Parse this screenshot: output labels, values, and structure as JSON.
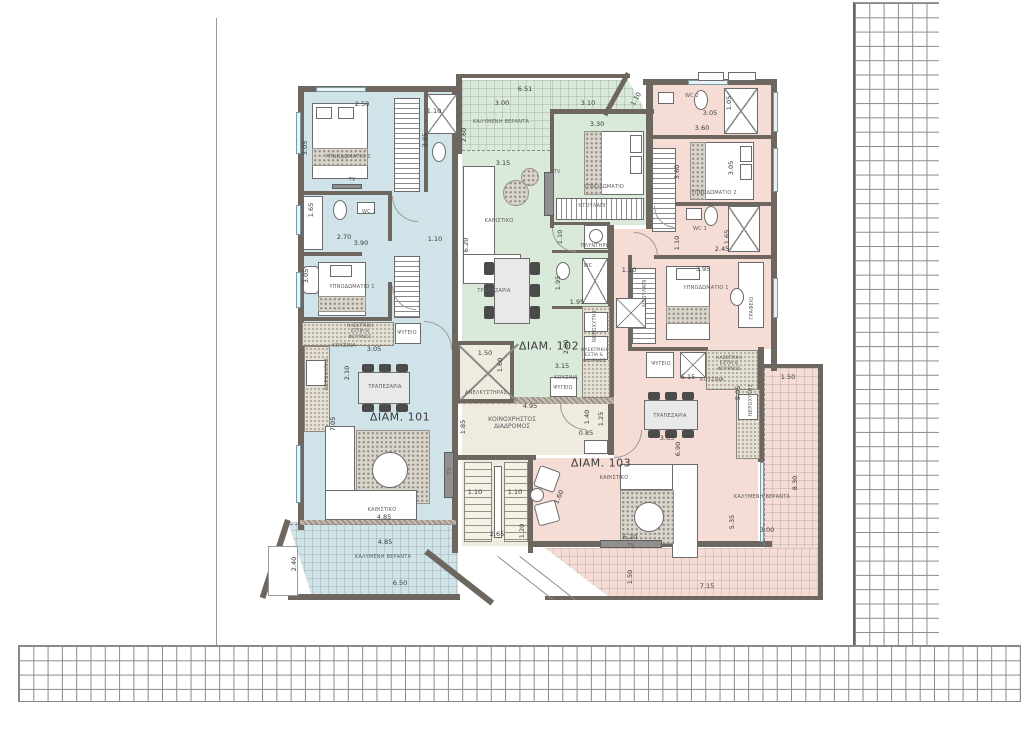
{
  "drawing": {
    "type": "architectural-floor-plan",
    "colors": {
      "apt101": "#cfe3e9",
      "apt102": "#d9e9da",
      "apt103": "#f5dcd4",
      "common": "#efecdf",
      "wall": "#6e675f",
      "dim": "#3a3a3a"
    },
    "apartments": [
      {
        "number": "101",
        "label": "ΔΙΑΜ. 101"
      },
      {
        "number": "102",
        "label": "ΔΙΑΜ. 102"
      },
      {
        "number": "103",
        "label": "ΔΙΑΜ. 103"
      }
    ],
    "texts": [
      {
        "t": "ΔΙΑΜ. 101",
        "x": 400,
        "y": 417,
        "k": "apt"
      },
      {
        "t": "ΔΙΑΜ. 102",
        "x": 549,
        "y": 346,
        "k": "apt"
      },
      {
        "t": "ΔΙΑΜ. 103",
        "x": 601,
        "y": 463,
        "k": "apt"
      },
      {
        "t": "ΥΠΝΟΔΩΜΑΤΙΟ 2",
        "x": 348,
        "y": 157,
        "k": "tiny"
      },
      {
        "t": "TV",
        "x": 352,
        "y": 180,
        "k": "tiny"
      },
      {
        "t": "WC 1",
        "x": 369,
        "y": 212,
        "k": "tiny"
      },
      {
        "t": "ΥΠΝΟΔΩΜΑΤΙΟ 1",
        "x": 352,
        "y": 287,
        "k": "tiny"
      },
      {
        "t": "ΗΛΕΚΤΡΙΚΗ ΕΣΤΙΑ & ΦΟΥΡΝΟΣ",
        "x": 360,
        "y": 332,
        "k": "wrap"
      },
      {
        "t": "ΨΥΓΕΙΟ",
        "x": 407,
        "y": 333,
        "k": "tiny"
      },
      {
        "t": "ΚΟΥΖΙΝΑ",
        "x": 344,
        "y": 346,
        "k": "tiny"
      },
      {
        "t": "ΝΕΡΟΧΥΤΗΣ",
        "x": 327,
        "y": 374,
        "k": "tiny",
        "r": -90
      },
      {
        "t": "ΤΡΑΠΕΖΑΡΙΑ",
        "x": 385,
        "y": 387,
        "k": "tiny"
      },
      {
        "t": "ΚΑΘΙΣΤΙΚΟ",
        "x": 382,
        "y": 510,
        "k": "tiny"
      },
      {
        "t": "ΚΑΛΥΜΕΝΗ ΒΕΡΑΝΤΑ",
        "x": 383,
        "y": 557,
        "k": "tiny"
      },
      {
        "t": "TV",
        "x": 450,
        "y": 471,
        "k": "tiny",
        "r": -90
      },
      {
        "t": "ΚΑΛΥΜΕΝΗ ΒΕΡΑΝΤΑ",
        "x": 501,
        "y": 122,
        "k": "tiny"
      },
      {
        "t": "ΚΑΘΙΣΤΙΚΟ",
        "x": 499,
        "y": 221,
        "k": "tiny"
      },
      {
        "t": "TV",
        "x": 557,
        "y": 172,
        "k": "tiny"
      },
      {
        "t": "ΥΠΝΟΔΩΜΑΤΙΟ",
        "x": 604,
        "y": 187,
        "k": "tiny"
      },
      {
        "t": "ΝΤΟΥΛΑΠΙ",
        "x": 592,
        "y": 206,
        "k": "tiny"
      },
      {
        "t": "ΠΛΥΝΤΗΡΙΟ",
        "x": 596,
        "y": 246,
        "k": "tiny"
      },
      {
        "t": "WC",
        "x": 588,
        "y": 266,
        "k": "tiny"
      },
      {
        "t": "ΤΡΑΠΕΖΑΡΙΑ",
        "x": 494,
        "y": 291,
        "k": "tiny"
      },
      {
        "t": "ΝΕΡΟΧΥΤΗΣ",
        "x": 595,
        "y": 326,
        "k": "tiny",
        "r": -90
      },
      {
        "t": "ΗΛΕΚΤΡΙΚΗ ΕΣΤΙΑ & ΦΟΥΡΝΟΣ",
        "x": 594,
        "y": 356,
        "k": "wrap"
      },
      {
        "t": "ΚΟΥΖΙΝΑ",
        "x": 566,
        "y": 378,
        "k": "tiny"
      },
      {
        "t": "ΨΥΓΕΙΟ",
        "x": 563,
        "y": 388,
        "k": "tiny"
      },
      {
        "t": "ΑΝΕΛΚΥΣΤΗΡΑΣ",
        "x": 486,
        "y": 393,
        "k": "tiny"
      },
      {
        "t": "ΚΟΙΝΟΧΡΗΣΤΟΣ ΔΙΑΔΡΟΜΟΣ",
        "x": 512,
        "y": 423,
        "k": "wrap2"
      },
      {
        "t": "WC 2",
        "x": 692,
        "y": 96,
        "k": "tiny"
      },
      {
        "t": "ΥΠΝΟΔΩΜΑΤΙΟ 2",
        "x": 714,
        "y": 193,
        "k": "tiny"
      },
      {
        "t": "WC 1",
        "x": 700,
        "y": 229,
        "k": "tiny"
      },
      {
        "t": "ΥΠΝΟΔΩΜΑΤΙΟ 1",
        "x": 706,
        "y": 288,
        "k": "tiny"
      },
      {
        "t": "ΝΤΟΥΛΑΠΙ",
        "x": 645,
        "y": 293,
        "k": "tiny",
        "r": -90
      },
      {
        "t": "ΓΡΑΦΕΙΟ",
        "x": 752,
        "y": 308,
        "k": "tiny",
        "r": -90
      },
      {
        "t": "ΨΥΓΕΙΟ",
        "x": 661,
        "y": 364,
        "k": "tiny"
      },
      {
        "t": "ΗΛΕΚΤΡΙΚΗ ΕΣΤΙΑ & ΦΟΥΡΝΟΣ",
        "x": 729,
        "y": 364,
        "k": "wrap"
      },
      {
        "t": "ΚΟΥΖΙΝΑ",
        "x": 712,
        "y": 380,
        "k": "tiny"
      },
      {
        "t": "ΝΕΡΟΧΥΤΗΣ",
        "x": 751,
        "y": 400,
        "k": "tiny",
        "r": -90
      },
      {
        "t": "ΤΡΑΠΕΖΑΡΙΑ",
        "x": 670,
        "y": 416,
        "k": "tiny"
      },
      {
        "t": "ΚΑΘΙΣΤΙΚΟ",
        "x": 614,
        "y": 478,
        "k": "tiny"
      },
      {
        "t": "TV",
        "x": 631,
        "y": 546,
        "k": "tiny"
      },
      {
        "t": "ΚΑΛΥΜΕΝΗ ΒΕΡΑΝΤΑ",
        "x": 762,
        "y": 497,
        "k": "tiny"
      },
      {
        "t": "3.05",
        "x": 305,
        "y": 148,
        "k": "dim",
        "r": -90
      },
      {
        "t": "2.50",
        "x": 362,
        "y": 104,
        "k": "dim"
      },
      {
        "t": "1.10",
        "x": 434,
        "y": 111,
        "k": "dim"
      },
      {
        "t": "2.85",
        "x": 425,
        "y": 140,
        "k": "dim",
        "r": -90
      },
      {
        "t": "1.65",
        "x": 311,
        "y": 210,
        "k": "dim",
        "r": -90
      },
      {
        "t": "2.70",
        "x": 344,
        "y": 237,
        "k": "dim"
      },
      {
        "t": "3.90",
        "x": 361,
        "y": 243,
        "k": "dim"
      },
      {
        "t": "1.10",
        "x": 435,
        "y": 239,
        "k": "dim"
      },
      {
        "t": "3.05",
        "x": 306,
        "y": 276,
        "k": "dim",
        "r": -90
      },
      {
        "t": "3.05",
        "x": 374,
        "y": 349,
        "k": "dim"
      },
      {
        "t": "2.10",
        "x": 347,
        "y": 373,
        "k": "dim",
        "r": -90
      },
      {
        "t": "7.05",
        "x": 333,
        "y": 424,
        "k": "dim",
        "r": -90
      },
      {
        "t": "4.85",
        "x": 384,
        "y": 517,
        "k": "dim"
      },
      {
        "t": "4.85",
        "x": 385,
        "y": 542,
        "k": "dim"
      },
      {
        "t": "2.40",
        "x": 294,
        "y": 564,
        "k": "dim",
        "r": -90
      },
      {
        "t": "6.50",
        "x": 400,
        "y": 583,
        "k": "dim"
      },
      {
        "t": "6.51",
        "x": 525,
        "y": 89,
        "k": "dim"
      },
      {
        "t": "3.00",
        "x": 502,
        "y": 103,
        "k": "dim"
      },
      {
        "t": "3.10",
        "x": 588,
        "y": 103,
        "k": "dim"
      },
      {
        "t": "1.10",
        "x": 636,
        "y": 99,
        "k": "dim",
        "r": -60
      },
      {
        "t": "2.60",
        "x": 464,
        "y": 135,
        "k": "dim",
        "r": -90
      },
      {
        "t": "3.30",
        "x": 597,
        "y": 124,
        "k": "dim"
      },
      {
        "t": "3.15",
        "x": 503,
        "y": 163,
        "k": "dim"
      },
      {
        "t": "6.20",
        "x": 466,
        "y": 245,
        "k": "dim",
        "r": -90
      },
      {
        "t": "1.10",
        "x": 560,
        "y": 237,
        "k": "dim",
        "r": -90
      },
      {
        "t": "1.95",
        "x": 558,
        "y": 283,
        "k": "dim",
        "r": -90
      },
      {
        "t": "1.95",
        "x": 577,
        "y": 302,
        "k": "dim"
      },
      {
        "t": "2.80",
        "x": 566,
        "y": 347,
        "k": "dim",
        "r": -90
      },
      {
        "t": "3.15",
        "x": 562,
        "y": 366,
        "k": "dim"
      },
      {
        "t": "1.50",
        "x": 485,
        "y": 353,
        "k": "dim"
      },
      {
        "t": "1.60",
        "x": 500,
        "y": 365,
        "k": "dim",
        "r": -90
      },
      {
        "t": "4.95",
        "x": 530,
        "y": 406,
        "k": "dim"
      },
      {
        "t": "1.85",
        "x": 463,
        "y": 427,
        "k": "dim",
        "r": -90
      },
      {
        "t": "1.40",
        "x": 587,
        "y": 417,
        "k": "dim",
        "r": -90
      },
      {
        "t": "1.25",
        "x": 601,
        "y": 419,
        "k": "dim",
        "r": -90
      },
      {
        "t": "0.85",
        "x": 586,
        "y": 433,
        "k": "dim"
      },
      {
        "t": "1.10",
        "x": 475,
        "y": 492,
        "k": "dim"
      },
      {
        "t": "1.10",
        "x": 515,
        "y": 492,
        "k": "dim"
      },
      {
        "t": "2.65",
        "x": 497,
        "y": 534,
        "k": "dim"
      },
      {
        "t": "1.20",
        "x": 522,
        "y": 531,
        "k": "dim",
        "r": -90
      },
      {
        "t": "1.60",
        "x": 559,
        "y": 497,
        "k": "dim",
        "r": -65
      },
      {
        "t": "3.05",
        "x": 710,
        "y": 113,
        "k": "dim"
      },
      {
        "t": "1.05",
        "x": 729,
        "y": 103,
        "k": "dim",
        "r": -90
      },
      {
        "t": "3.60",
        "x": 702,
        "y": 128,
        "k": "dim"
      },
      {
        "t": "3.60",
        "x": 677,
        "y": 172,
        "k": "dim",
        "r": -90
      },
      {
        "t": "3.05",
        "x": 731,
        "y": 168,
        "k": "dim",
        "r": -90
      },
      {
        "t": "1.10",
        "x": 677,
        "y": 243,
        "k": "dim",
        "r": -90
      },
      {
        "t": "1.65",
        "x": 727,
        "y": 237,
        "k": "dim",
        "r": -90
      },
      {
        "t": "2.45",
        "x": 722,
        "y": 249,
        "k": "dim"
      },
      {
        "t": "1.10",
        "x": 629,
        "y": 270,
        "k": "dim"
      },
      {
        "t": "3.95",
        "x": 703,
        "y": 269,
        "k": "dim"
      },
      {
        "t": "5.15",
        "x": 688,
        "y": 377,
        "k": "dim"
      },
      {
        "t": "5.05",
        "x": 738,
        "y": 393,
        "k": "dim",
        "r": -90
      },
      {
        "t": "1.50",
        "x": 788,
        "y": 377,
        "k": "dim"
      },
      {
        "t": "3.65",
        "x": 667,
        "y": 438,
        "k": "dim"
      },
      {
        "t": "6.90",
        "x": 678,
        "y": 449,
        "k": "dim",
        "r": -90
      },
      {
        "t": "6.20",
        "x": 630,
        "y": 537,
        "k": "dim"
      },
      {
        "t": "8.30",
        "x": 795,
        "y": 483,
        "k": "dim",
        "r": -90
      },
      {
        "t": "5.35",
        "x": 732,
        "y": 522,
        "k": "dim",
        "r": -90
      },
      {
        "t": "3.00",
        "x": 767,
        "y": 530,
        "k": "dim"
      },
      {
        "t": "1.50",
        "x": 630,
        "y": 577,
        "k": "dim",
        "r": -90
      },
      {
        "t": "7.15",
        "x": 707,
        "y": 586,
        "k": "dim"
      }
    ]
  }
}
